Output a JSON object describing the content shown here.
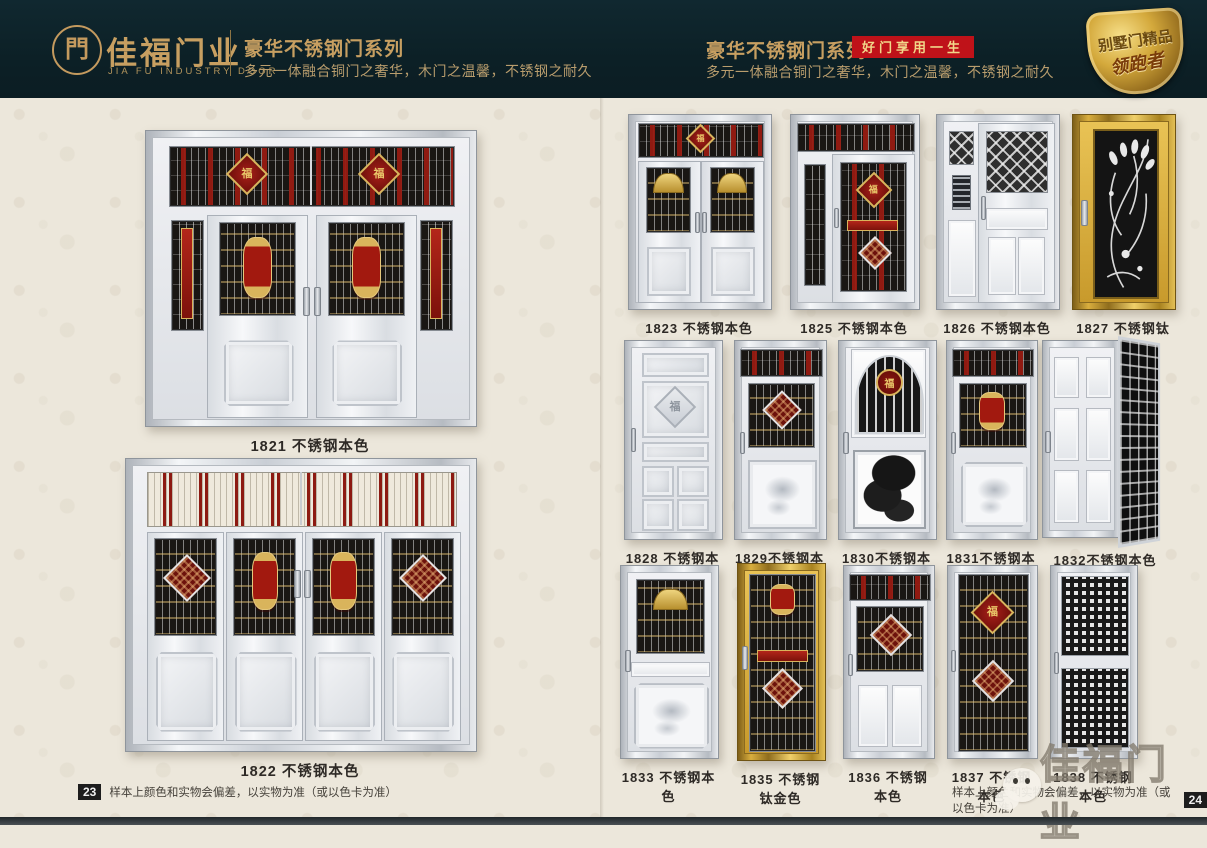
{
  "header": {
    "logo": {
      "glyph": "門",
      "brand": "佳福门业",
      "brand_en": "JIA FU INDUSTRY DOOR"
    },
    "left": {
      "series_title": "豪华不锈钢门系列",
      "tagline": "多元一体融合铜门之奢华，木门之温馨，不锈钢之耐久"
    },
    "right": {
      "series_title": "豪华不锈钢门系列",
      "badge": "好门享用一生",
      "tagline": "多元一体融合铜门之奢华，木门之温馨，不锈钢之耐久"
    },
    "shield": {
      "line1": "别墅门精品",
      "line2": "领跑者"
    }
  },
  "motifs": {
    "fu": "福"
  },
  "pages": {
    "left": {
      "doors": [
        {
          "id": "1821",
          "label": "1821 不锈钢本色"
        },
        {
          "id": "1822",
          "label": "1822 不锈钢本色"
        }
      ],
      "footer": {
        "page_no": "23",
        "disclaimer": "样本上颜色和实物会偏差，以实物为准（或以色卡为准）"
      }
    },
    "right": {
      "rows": [
        {
          "doors": [
            {
              "id": "1823",
              "label": "1823 不锈钢本色"
            },
            {
              "id": "1825",
              "label": "1825 不锈钢本色"
            },
            {
              "id": "1826",
              "label": "1826 不锈钢本色"
            },
            {
              "id": "1827",
              "label": "1827 不锈钢钛金色"
            }
          ]
        },
        {
          "doors": [
            {
              "id": "1828",
              "label": "1828 不锈钢本色"
            },
            {
              "id": "1829",
              "label": "1829不锈钢本色"
            },
            {
              "id": "1830",
              "label": "1830不锈钢本色"
            },
            {
              "id": "1831",
              "label": "1831不锈钢本色"
            },
            {
              "id": "1832",
              "label": "1832不锈钢本色"
            }
          ]
        },
        {
          "doors": [
            {
              "id": "1833",
              "label": "1833 不锈钢本色"
            },
            {
              "id": "1835",
              "label": "1835 不锈钢钛金色"
            },
            {
              "id": "1836",
              "label": "1836 不锈钢本色"
            },
            {
              "id": "1837",
              "label": "1837 不锈钢本色"
            },
            {
              "id": "1838",
              "label": "1838 不锈钢本色"
            }
          ]
        }
      ],
      "footer": {
        "page_no": "24",
        "disclaimer": "样本上颜色和实物会偏差，以实物为准（或以色卡为准）"
      }
    }
  },
  "watermark": {
    "text": "佳福门业"
  },
  "colors": {
    "header_bg": "#0c2026",
    "gold": "#c79f61",
    "badge_red": "#bf1219",
    "paper": "#ece7db",
    "grille_black": "#191613",
    "accent_red": "#8d1a12",
    "titanium_gold": "#d9ae3e"
  }
}
